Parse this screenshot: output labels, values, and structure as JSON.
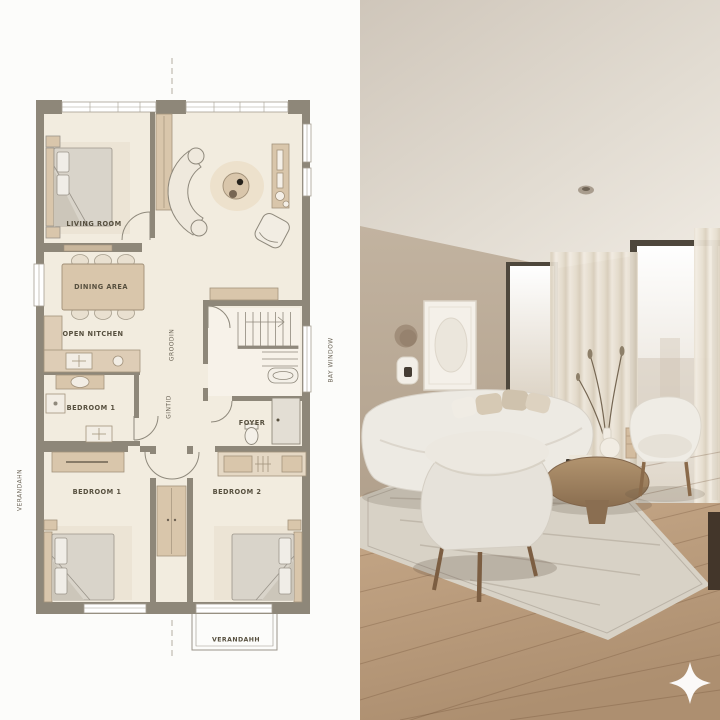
{
  "panels": {
    "left_name": "floor-plan",
    "right_name": "interior-photo"
  },
  "floor_plan": {
    "labels": {
      "living_room": "LIVING ROOM",
      "dining_area": "DINING AREA",
      "open_kitchen": "OPEN NITCHEN",
      "bath_room": "BEDROOM 1",
      "foyer": "FOYER",
      "bedroom_1": "BEDROOM 1",
      "bedroom_2": "BEDROOM 2",
      "verandah": "VERANDAHH",
      "verandah_side": "VERANDAHN",
      "bay_window": "BAY WINDOW",
      "corridor_a": "GROODIN",
      "corridor_b": "GINTID"
    },
    "colors": {
      "wall": "#8e8779",
      "floor": "#f2ecdf",
      "furniture_tan": "#d9c6ab",
      "mattress_gray": "#d9d4ca",
      "outline": "#8f897c",
      "label_text": "#57503f",
      "paper": "#fcfcfa"
    }
  },
  "photo": {
    "watermark_icon": "sparkle-icon",
    "colors": {
      "ceiling": "#e0d9cf",
      "wall": "#b4a491",
      "window_frame": "#4e473c",
      "glass": "#f6f2ea",
      "curtain": "#ece4d6",
      "sofa": "#edeae3",
      "rug": "#d8d2c6",
      "wood_floor": "#b3916f",
      "coffee_table": "#a2825f"
    }
  }
}
